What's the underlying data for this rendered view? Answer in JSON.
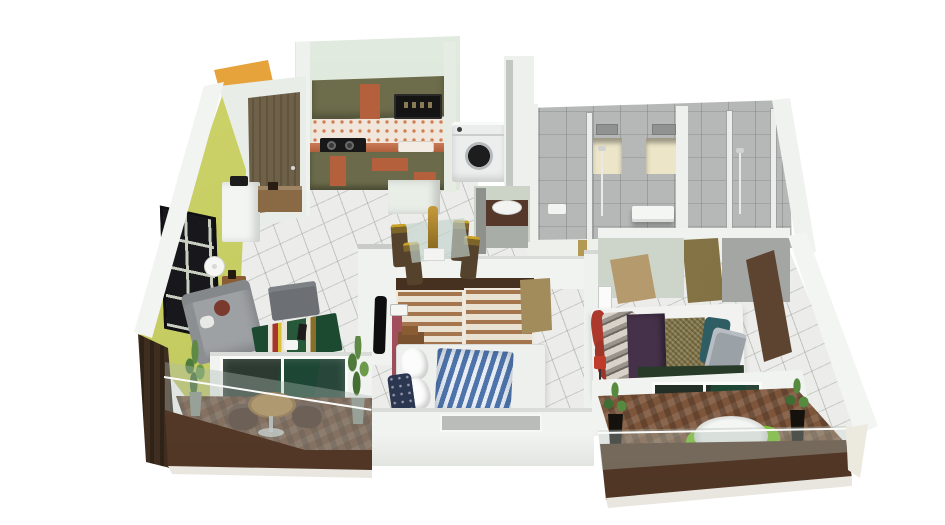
{
  "meta": {
    "title": "3D isometric apartment floor plan render",
    "view": "isometric top-down cutaway",
    "canvas": {
      "width": 945,
      "height": 525
    },
    "background": "#ffffff",
    "visible_text": []
  },
  "palette": {
    "wall_white": "#f1f3f0",
    "wall_pale_green": "#dde7da",
    "wall_chartreuse": "#c9cf63",
    "canopy_orange": "#e6a33c",
    "cabinet_olive": "#6d6d4c",
    "accent_orange": "#c2643e",
    "counter_terracotta": "#bd6847",
    "floor_tile": "#ecedea",
    "bath_tile_gray": "#b6b8b7",
    "niche_cream": "#ece5c8",
    "door_wood": "#6f6148",
    "door_tan": "#8a7a4a",
    "wardrobe_stripe": "#a5764e",
    "duvet_blue": "#4d74ab",
    "pillow_navy": "#2b3651",
    "maroon_wall_edge": "#a34e5c",
    "runner_purple": "#453149",
    "blanket_olive": "#867a4b",
    "pillow_teal": "#2e5e64",
    "pillow_red": "#ad392d",
    "sofa_gray": "#9ea1a4",
    "rug_green": "#1c4a31",
    "chair_green": "#76c421",
    "balcony_wood": "#6b4530",
    "parapet_brown": "#55392a",
    "dark_wood_wall": "#3f2d1f",
    "glass_curtain_green": "#1d4634",
    "chrome": "#c8cbcd",
    "statue_gold": "#b08830",
    "dresser_brown": "#5d4431"
  },
  "rooms": {
    "kitchen": {
      "label": "Kitchen",
      "features": [
        "olive upper and lower cabinets with orange accent panels",
        "black built-in microwave",
        "dotted tile backsplash",
        "terracotta countertop",
        "two-burner gas cooktop",
        "sink",
        "white front-load washing machine",
        "white tile floor"
      ]
    },
    "entry": {
      "label": "Entry",
      "features": [
        "brown wooden front door",
        "orange canopy wedge",
        "white console cabinet",
        "wooden sideboard"
      ]
    },
    "living_room": {
      "label": "Living Room",
      "features": [
        "chartreuse accent wall with black window grid",
        "gray fabric sofa with maroon cushion",
        "round floor lamp",
        "wooden side table",
        "gray ottoman coffee table",
        "green striped rug",
        "TV mounted on white partition",
        "two potted plants",
        "sliding glass door to balcony"
      ]
    },
    "dining": {
      "label": "Dining Area",
      "features": [
        "glass dining table",
        "four bronze high-back chairs",
        "gold statue centerpiece",
        "dark wood wash-basin vanity with white oval basin"
      ]
    },
    "bathrooms": {
      "label": "Bathrooms",
      "features": [
        "gray wall tiles",
        "two lit storage niches",
        "glass shower partitions",
        "chrome shower sets",
        "white basin counters",
        "tan connecting door"
      ]
    },
    "bedroom_2": {
      "label": "Bedroom 2",
      "features": [
        "sliding wardrobe with brown striped panels",
        "bed with blue-white striped duvet",
        "white pillows",
        "navy patterned pillows",
        "brown headboard",
        "maroon wall edge",
        "tan door",
        "window slot in south wall"
      ]
    },
    "master_bedroom": {
      "label": "Master Bedroom",
      "features": [
        "bed with purple runner and olive textured blanket",
        "teal, gray and red pillows",
        "dark green foot bench",
        "tall brown dresser",
        "tan leaning headboard panel",
        "red floor lamp",
        "sliding glass door to balcony"
      ]
    },
    "balcony_left": {
      "label": "Left Balcony",
      "features": [
        "wood plank floor",
        "round wooden pedestal table",
        "two dark red chairs",
        "two tall potted plants",
        "glass railing over brown parapet",
        "dark wood side wall"
      ]
    },
    "balcony_right": {
      "label": "Right Balcony",
      "features": [
        "herringbone wood floor",
        "white round pedestal table",
        "two bright green chairs",
        "two black planters with grasses",
        "glass railing over brown parapet"
      ]
    }
  }
}
